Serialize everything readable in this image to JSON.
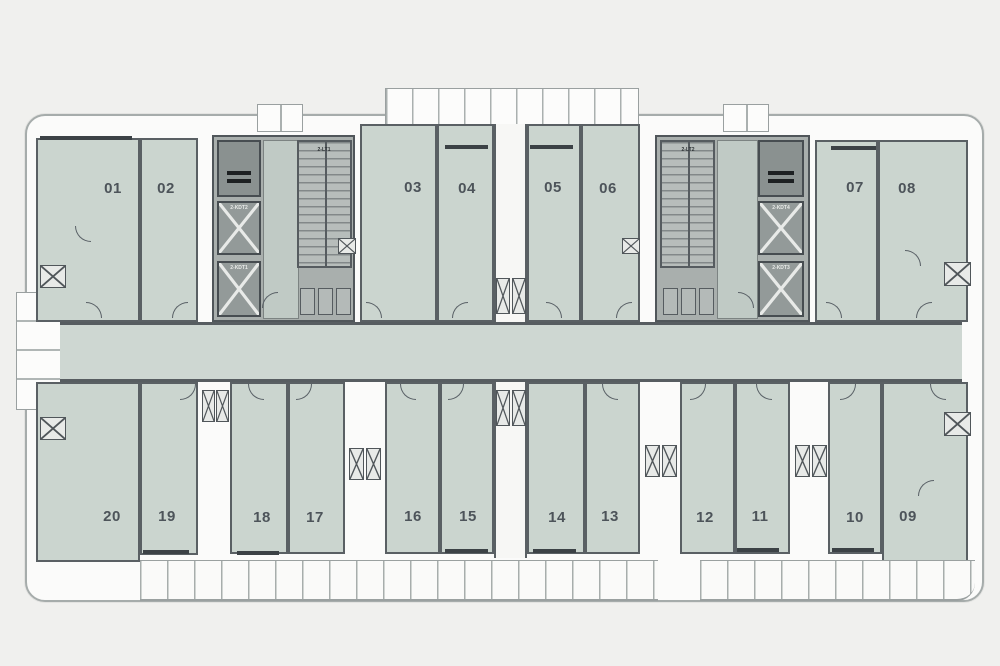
{
  "figure": {
    "type": "apartment-floor-plan",
    "description": "Residential tower standard floor plan with central corridor, 20 numbered units, two stair/elevator cores and perimeter balconies"
  },
  "palette": {
    "background": "#f0f0ee",
    "unit_fill": "#cbd5cf",
    "corridor_fill": "#ced7d2",
    "wall": "#5a6064",
    "core_fill": "#a9afad",
    "core_box": "#939a99",
    "envelope": "#fbfbfa",
    "outline": "#a6acab",
    "label_text": "#4d545a"
  },
  "plan": {
    "top_units": [
      "01",
      "02",
      "03",
      "04",
      "05",
      "06",
      "07",
      "08"
    ],
    "bottom_units": [
      "20",
      "19",
      "18",
      "17",
      "16",
      "15",
      "14",
      "13",
      "12",
      "11",
      "10",
      "09"
    ],
    "cores": {
      "left": {
        "stair": "2-LT1",
        "elev_mid": "2-KDT2",
        "elev_bottom": "2-KDT1"
      },
      "right": {
        "stair": "2-LT2",
        "elev_mid": "2-KDT4",
        "elev_bottom": "2-KDT3"
      }
    }
  }
}
